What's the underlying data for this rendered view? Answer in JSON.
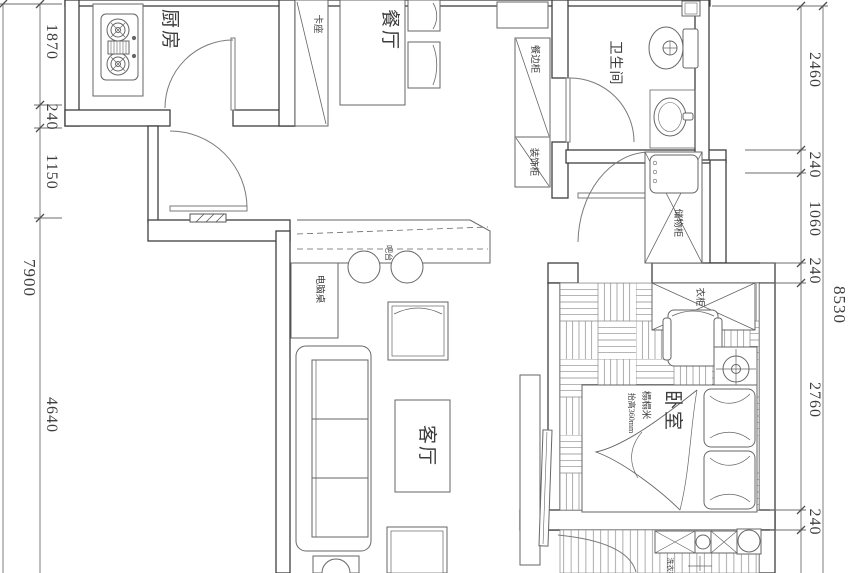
{
  "drawing": {
    "type": "apartment-floor-plan"
  },
  "rooms": {
    "kitchen": "厨房",
    "dining": "餐厅",
    "bathroom": "卫生间",
    "living": "客厅",
    "bedroom": "卧室"
  },
  "furniture": {
    "booth": "卡座",
    "sideboard": "餐边柜",
    "decor_cabinet": "装饰柜",
    "storage_cabinet": "储物柜",
    "wardrobe": "衣柜",
    "bar": "吧台",
    "computer_desk": "电脑桌",
    "tatami": "榻榻米",
    "tatami_note": "抬高360mm",
    "washer": "洗衣机"
  },
  "dimensions": {
    "left_outer": "7900",
    "left": [
      "1870",
      "240",
      "1150",
      "4640"
    ],
    "right": [
      "2460",
      "240",
      "1060",
      "240",
      "2760",
      "240"
    ],
    "right_outer": "8530"
  },
  "colors": {
    "wall": "#3f3f3f",
    "furniture": "#666666",
    "dimension": "#4f4f4f",
    "pattern": "#8a8a8a",
    "background": "#ffffff"
  }
}
